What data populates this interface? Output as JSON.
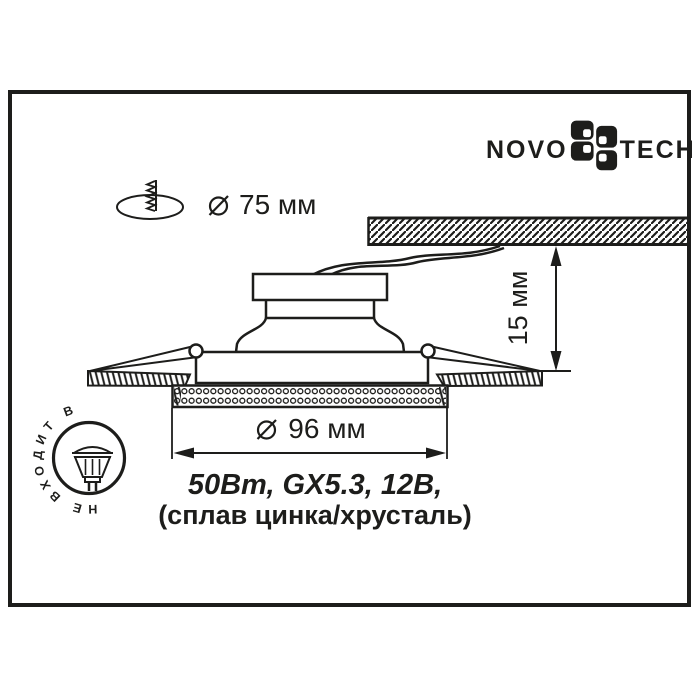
{
  "brand": {
    "left": "NOVO",
    "right": "TECH"
  },
  "cutout": {
    "value": "75 мм"
  },
  "outer_diameter": {
    "value": "96 мм"
  },
  "depth": {
    "value": "15 мм"
  },
  "specs": {
    "lamp": "50Вт, GX5.3, 12В,",
    "material": "(сплав цинка/хрусталь)"
  },
  "stamp": {
    "text": "НЕ ВХОДИТ В КОМПЛЕКТ"
  },
  "colors": {
    "ink": "#1d1d1b",
    "paper": "#ffffff"
  }
}
